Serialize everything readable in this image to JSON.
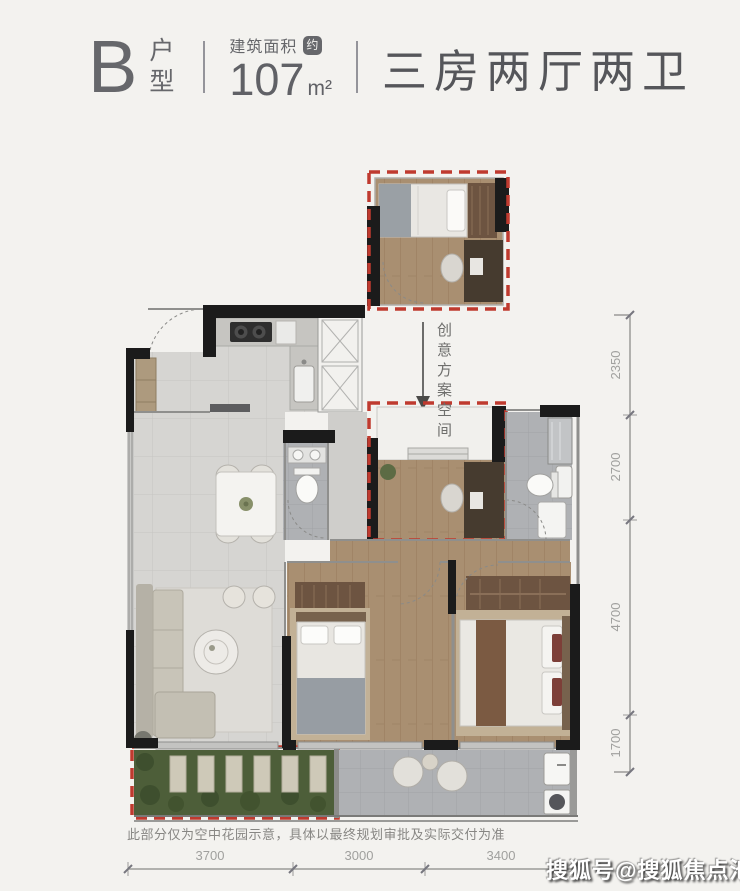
{
  "page": {
    "background": "#f3f2ef"
  },
  "header": {
    "unit_letter": "B",
    "unit_type_label": "户型",
    "area_label": "建筑面积",
    "area_approx_badge": "约",
    "area_value": "107",
    "area_unit": "m²",
    "layout_label": "三房两厅两卫",
    "text_color": "#64656a"
  },
  "plan": {
    "creative_space_label": "创意方案空间",
    "disclaimer_note": "此部分仅为空中花园示意，具体以最终规划审批及实际交付为准",
    "colors": {
      "dashed_outline": "#bf3a2f",
      "wall": "#1b1b1b",
      "wood_floor": "#ab9174",
      "tile_floor": "#d6d5d2",
      "bath_floor": "#afb1b4",
      "garden_green": "#4d5e39",
      "balcony_floor": "#b7babc"
    }
  },
  "dimensions": {
    "bottom": [
      "3700",
      "3000",
      "3400"
    ],
    "right": [
      "2350",
      "2700",
      "4700",
      "1700"
    ]
  },
  "watermark": {
    "text": "搜狐号@搜狐焦点池州站"
  }
}
